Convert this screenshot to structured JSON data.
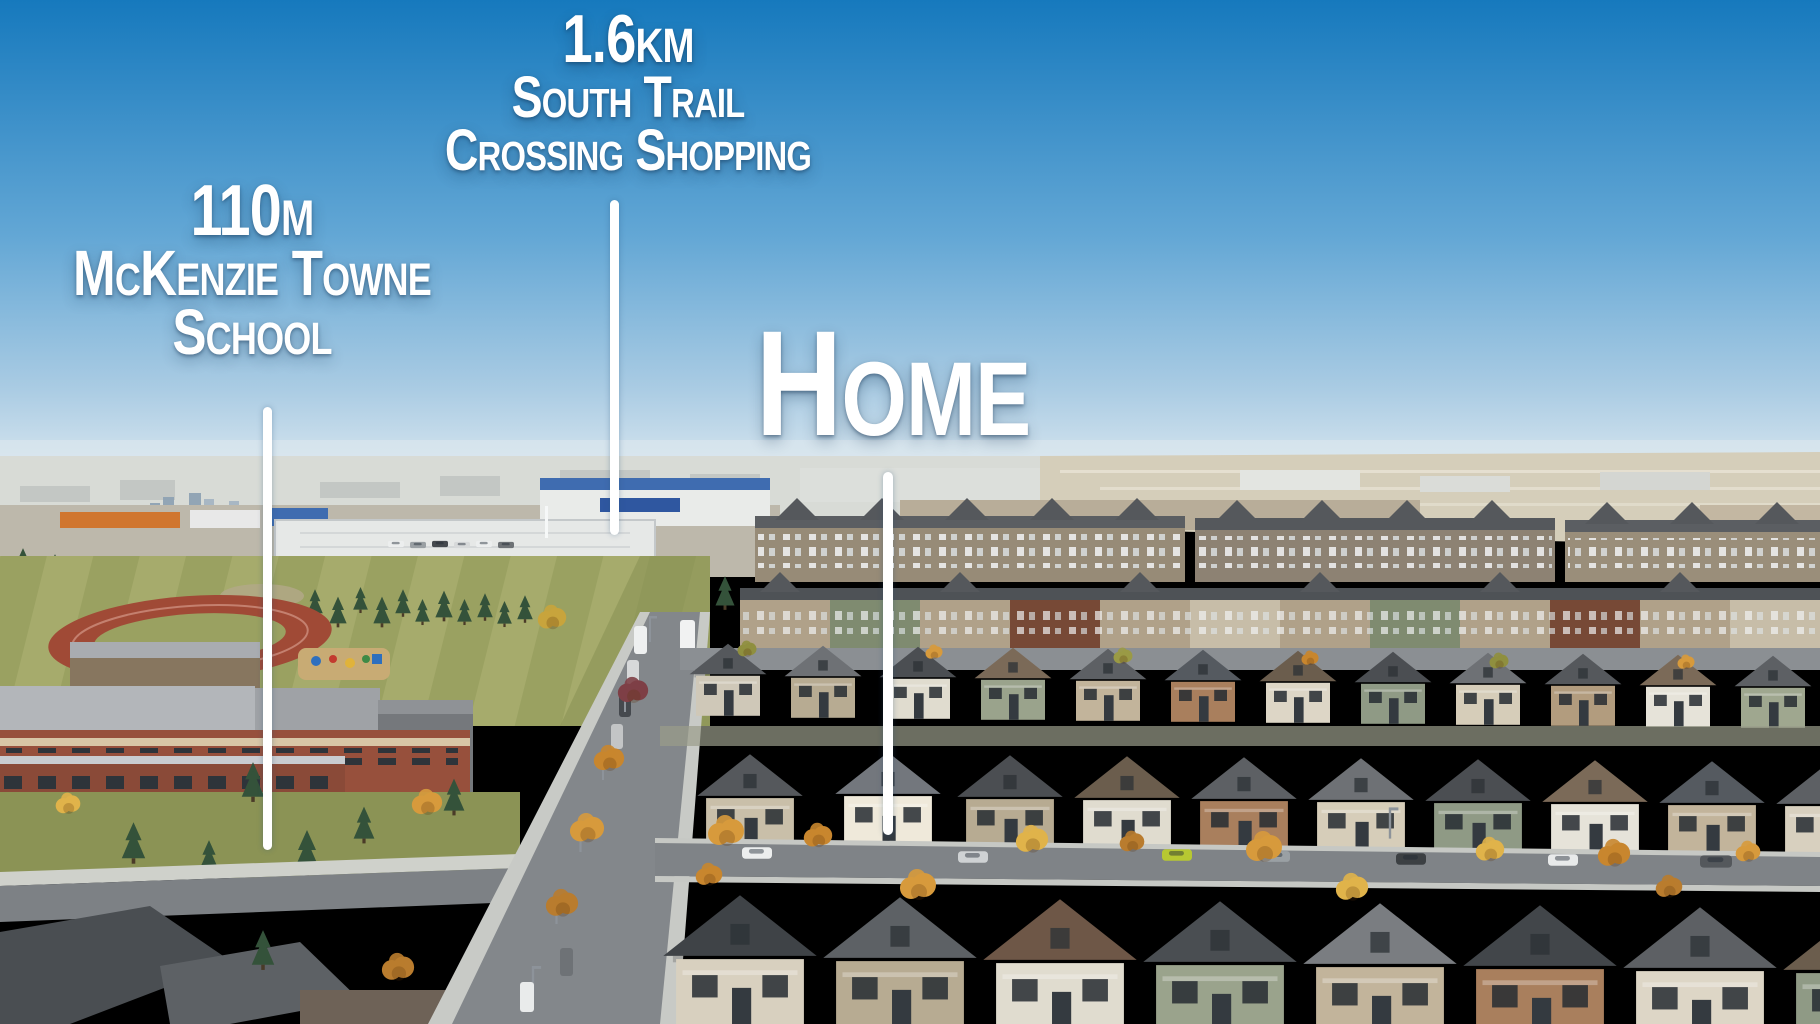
{
  "annotations": {
    "school": {
      "distance": "110m",
      "name_line1": "McKenzie Towne",
      "name_line2": "School"
    },
    "shopping": {
      "distance": "1.6km",
      "name_line1": "South Trail",
      "name_line2": "Crossing Shopping"
    },
    "home": {
      "label": "Home"
    }
  },
  "colors": {
    "sky_top": "#1679bd",
    "sky_mid": "#63a7d5",
    "sky_horizon": "#d8e6ef",
    "annotation_text": "#ffffff",
    "pointer_line": "#ffffff",
    "field_green": "#9aa161",
    "track_red": "#a04a36",
    "school_brick": "#97503c",
    "roof_gray": "#5d6064",
    "autumn_tree": "#d79a3c"
  }
}
